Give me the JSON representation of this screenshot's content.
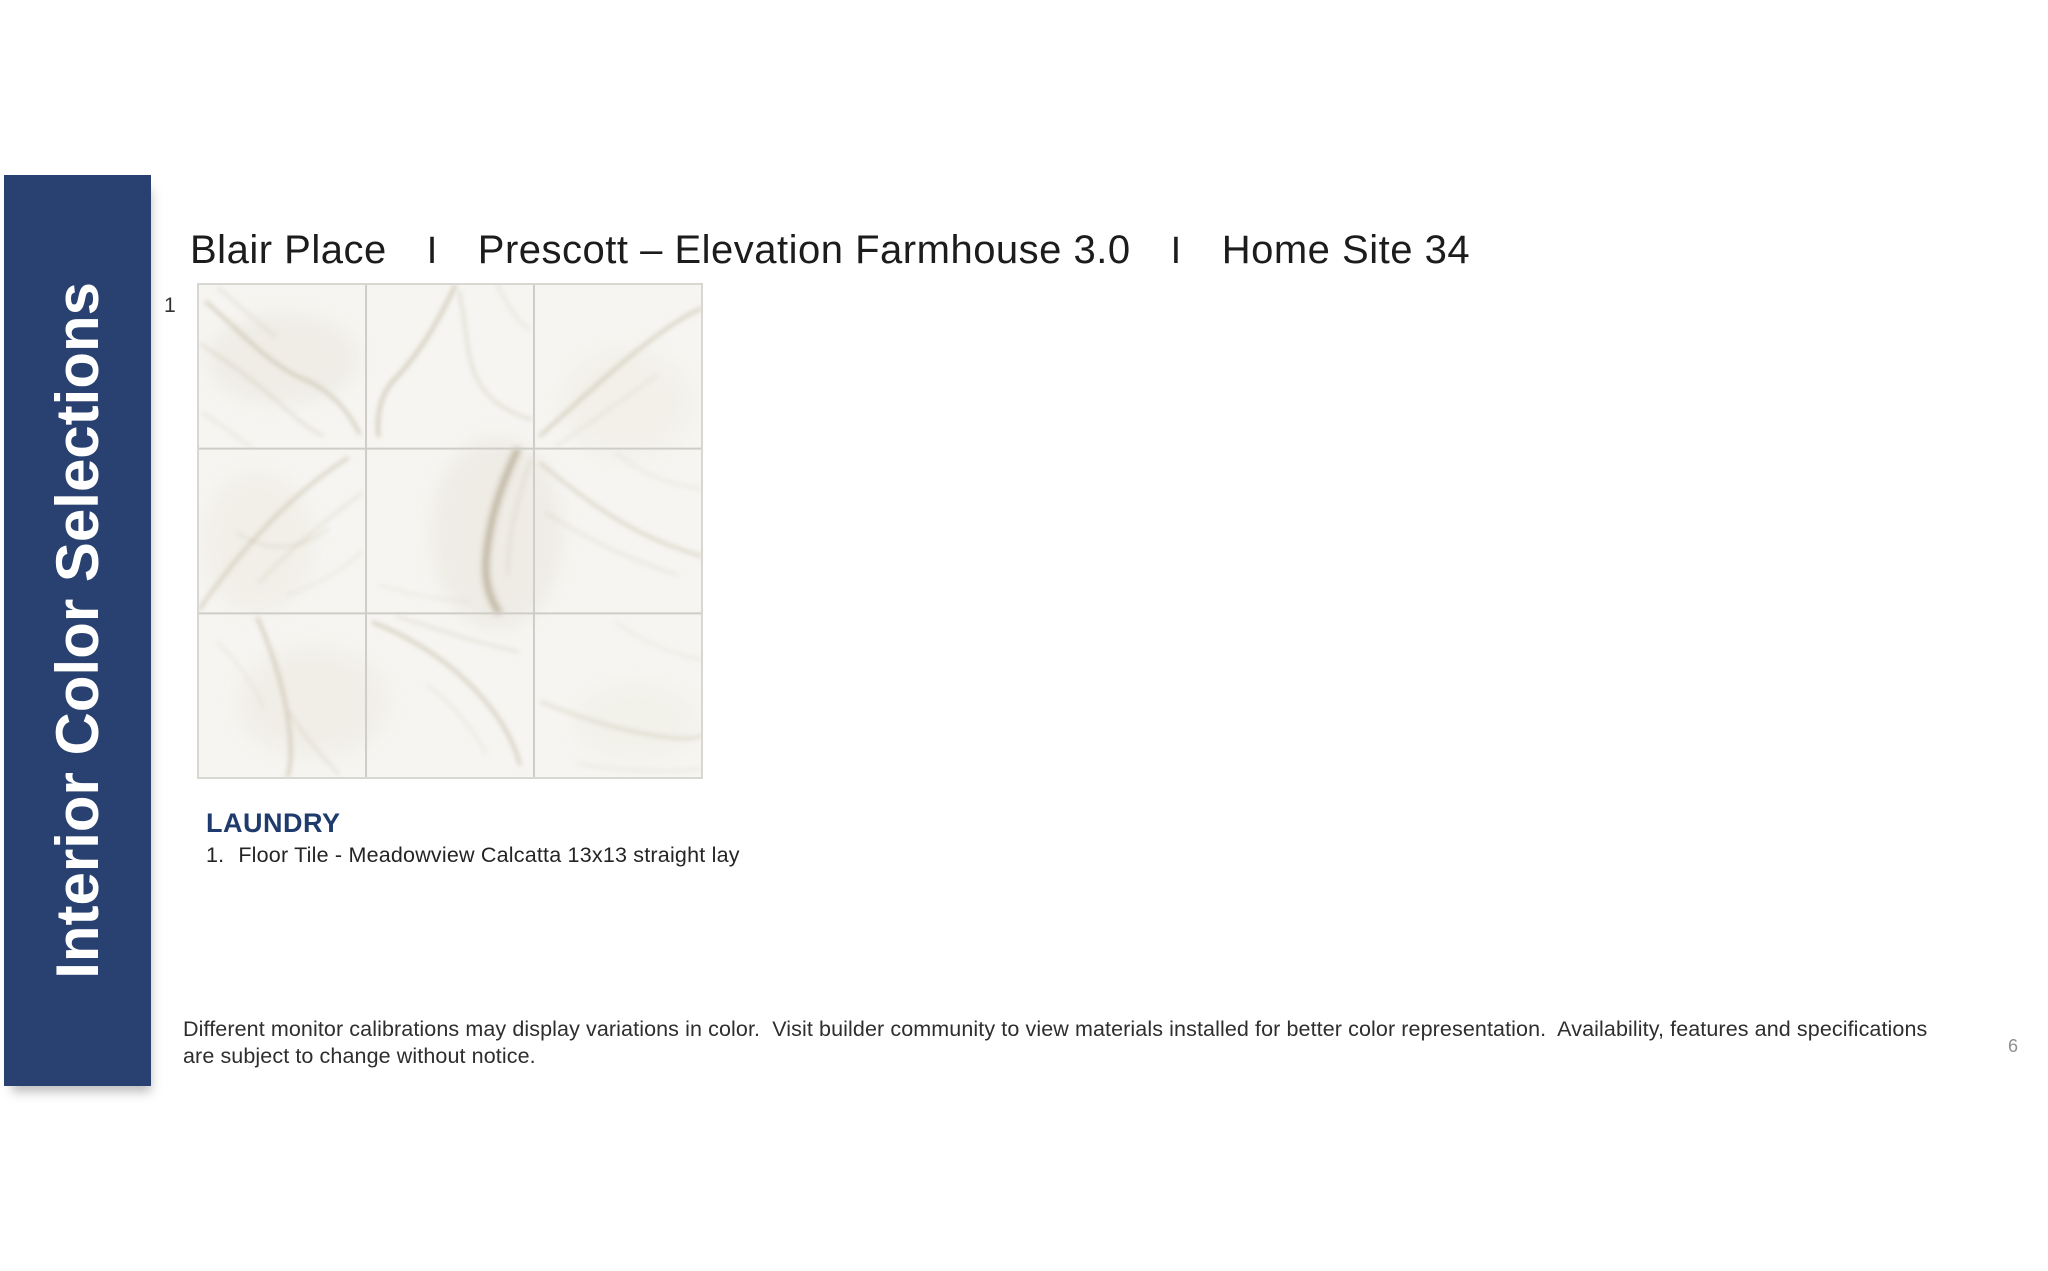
{
  "colors": {
    "sidebar-navy": "#294170",
    "heading-navy": "#1f3a6c",
    "title-ink": "#1c1c1c",
    "body-ink": "#2e2e2e",
    "page-num-gray": "#8f8f8f",
    "tile-base": "#f6f5f1",
    "grout": "#cfcdc8"
  },
  "sidebar": {
    "label": "Interior Color Selections"
  },
  "header": {
    "parts": [
      "Blair Place",
      "Prescott – Elevation Farmhouse 3.0",
      "Home Site 34"
    ],
    "separator": "I"
  },
  "figure": {
    "number": "1",
    "description": "marble floor tile sample, 3x3 straight lay"
  },
  "section": {
    "heading": "LAUNDRY",
    "items": [
      {
        "index": "1.",
        "label": "Floor Tile - Meadowview Calcatta 13x13 straight lay"
      }
    ]
  },
  "footer": {
    "disclaimer": "Different monitor calibrations may display variations in color.  Visit builder community to view materials installed for better color representation.  Availability, features and specifications are subject to change without notice.",
    "page_number": "6"
  }
}
